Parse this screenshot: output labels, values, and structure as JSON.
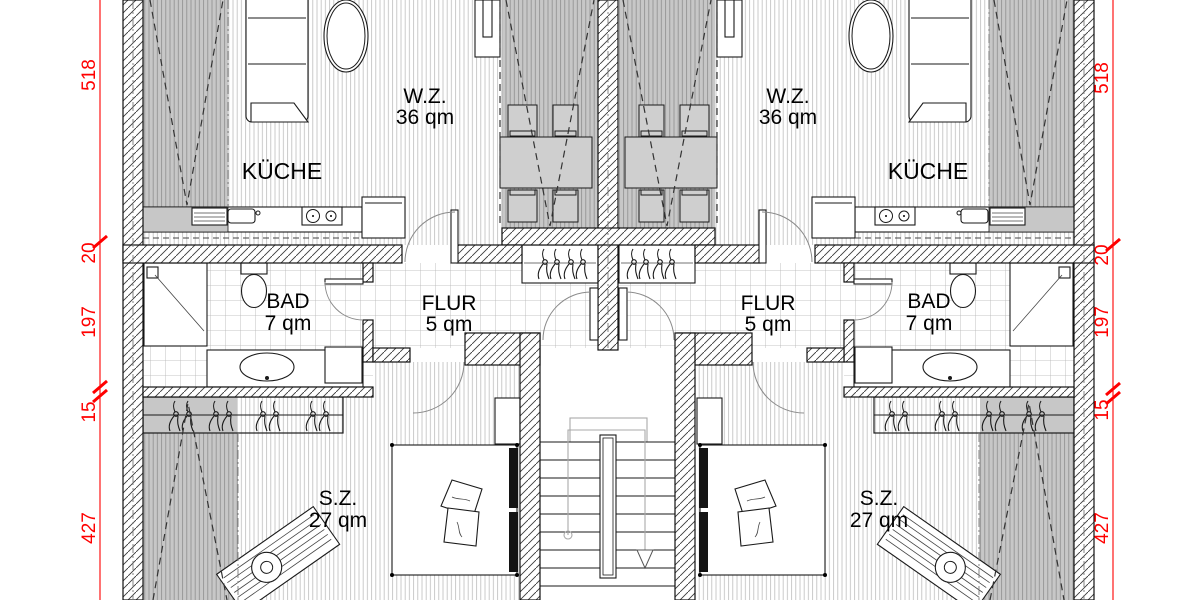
{
  "plan": {
    "type": "floor-plan",
    "rooms": {
      "wz": {
        "name": "W.Z.",
        "area": "36 qm"
      },
      "kueche": {
        "name": "KÜCHE"
      },
      "bad": {
        "name": "BAD",
        "area": "7 qm"
      },
      "flur": {
        "name": "FLUR",
        "area": "5 qm"
      },
      "sz": {
        "name": "S.Z.",
        "area": "27 qm"
      }
    },
    "dimensions": {
      "chain": [
        "518",
        "20",
        "197",
        "15",
        "427"
      ]
    },
    "colors": {
      "dimension_red": "#ff0000",
      "wall_line": "#111111",
      "slope_gray": "#c7c7c7"
    }
  }
}
